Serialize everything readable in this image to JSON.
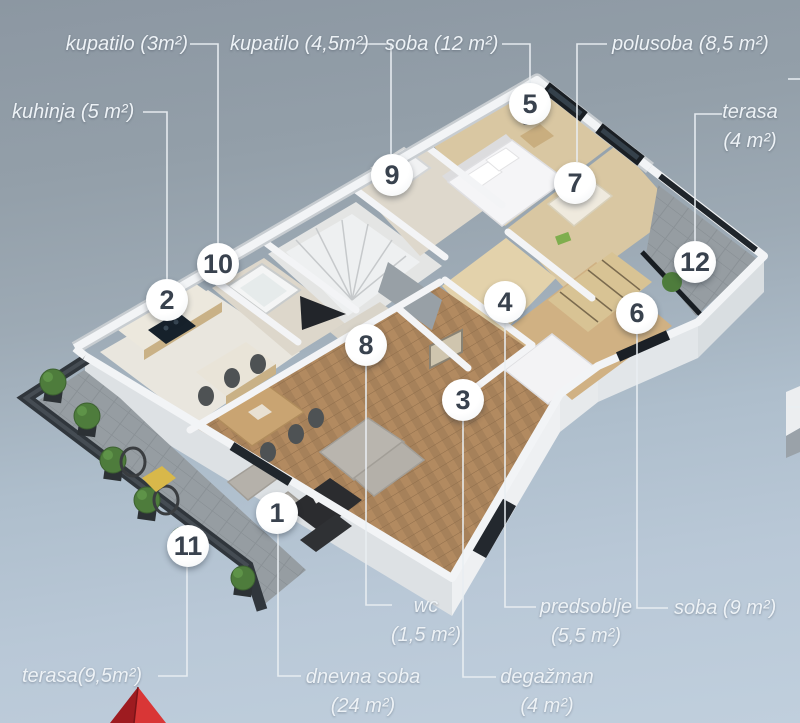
{
  "scene_title": "apartment 3D floor plan",
  "colors": {
    "background_top": "#8c97a2",
    "background_bottom": "#c0cfdd",
    "label_text": "#edf2f6",
    "leader_line": "#e9eef2",
    "marker_background": "#ffffff",
    "marker_number": "#39424e",
    "arrow_red": "#d93636"
  },
  "rooms": [
    {
      "number": "1",
      "name": "dnevna soba",
      "area": "24 m²"
    },
    {
      "number": "2",
      "name": "kuhinja",
      "area": "5 m²"
    },
    {
      "number": "3",
      "name": "degažman",
      "area": "4 m²"
    },
    {
      "number": "4",
      "name": "predsoblje",
      "area": "5,5 m²"
    },
    {
      "number": "5",
      "name": "soba",
      "area": "12 m²"
    },
    {
      "number": "6",
      "name": "soba",
      "area": "9 m²"
    },
    {
      "number": "7",
      "name": "polusoba",
      "area": "8,5 m²"
    },
    {
      "number": "8",
      "name": "wc",
      "area": "1,5 m²"
    },
    {
      "number": "9",
      "name": "kupatilo",
      "area": "4,5 m²"
    },
    {
      "number": "10",
      "name": "kupatilo",
      "area": "3 m²"
    },
    {
      "number": "11",
      "name": "terasa",
      "area": "9,5 m²"
    },
    {
      "number": "12",
      "name": "terasa",
      "area": "4 m²"
    }
  ],
  "markers": [
    {
      "n": "1",
      "x": 277,
      "y": 513
    },
    {
      "n": "2",
      "x": 167,
      "y": 300
    },
    {
      "n": "3",
      "x": 463,
      "y": 400
    },
    {
      "n": "4",
      "x": 505,
      "y": 302
    },
    {
      "n": "5",
      "x": 530,
      "y": 104
    },
    {
      "n": "6",
      "x": 637,
      "y": 313
    },
    {
      "n": "7",
      "x": 575,
      "y": 183
    },
    {
      "n": "8",
      "x": 366,
      "y": 345
    },
    {
      "n": "9",
      "x": 392,
      "y": 175
    },
    {
      "n": "10",
      "x": 218,
      "y": 264
    },
    {
      "n": "11",
      "x": 188,
      "y": 546
    },
    {
      "n": "12",
      "x": 695,
      "y": 262
    }
  ],
  "labels": [
    {
      "id": "kupatilo-3",
      "marker": "10",
      "lines": [
        "kupatilo (3m²)"
      ],
      "x": 28,
      "y": 30,
      "w": 160,
      "align": "right"
    },
    {
      "id": "kupatilo-45",
      "marker": "9",
      "lines": [
        "kupatilo (4,5m²)"
      ],
      "x": 230,
      "y": 30,
      "w": 130,
      "align": "center"
    },
    {
      "id": "soba-12",
      "marker": "5",
      "lines": [
        "soba (12 m²)"
      ],
      "x": 385,
      "y": 30,
      "w": 113,
      "align": "right"
    },
    {
      "id": "polusoba-85",
      "marker": "7",
      "lines": [
        "polusoba (8,5 m²)"
      ],
      "x": 612,
      "y": 30,
      "w": 145,
      "align": "left"
    },
    {
      "id": "kuhinja-5",
      "marker": "2",
      "lines": [
        "kuhinja (5 m²)"
      ],
      "x": 12,
      "y": 98,
      "w": 128,
      "align": "left"
    },
    {
      "id": "terasa-4",
      "marker": "12",
      "lines": [
        "terasa",
        "(4 m²)"
      ],
      "x": 710,
      "y": 98,
      "w": 80,
      "align": "center"
    },
    {
      "id": "wc-15",
      "marker": "8",
      "lines": [
        "wc",
        "(1,5 m²)"
      ],
      "x": 386,
      "y": 592,
      "w": 80,
      "align": "center"
    },
    {
      "id": "predsoblje-55",
      "marker": "4",
      "lines": [
        "predsoblje",
        "(5,5 m²)"
      ],
      "x": 536,
      "y": 593,
      "w": 100,
      "align": "center"
    },
    {
      "id": "soba-9",
      "marker": "6",
      "lines": [
        "soba (9 m²)"
      ],
      "x": 674,
      "y": 594,
      "w": 112,
      "align": "left"
    },
    {
      "id": "dnevna-soba-24",
      "marker": "1",
      "lines": [
        "dnevna soba",
        "(24 m²)"
      ],
      "x": 302,
      "y": 663,
      "w": 122,
      "align": "center"
    },
    {
      "id": "degazman-4",
      "marker": "3",
      "lines": [
        "degažman",
        "(4 m²)"
      ],
      "x": 497,
      "y": 663,
      "w": 100,
      "align": "center"
    },
    {
      "id": "terasa-95",
      "marker": "11",
      "lines": [
        "terasa(9,5m²)"
      ],
      "x": 22,
      "y": 662,
      "w": 136,
      "align": "left"
    }
  ]
}
